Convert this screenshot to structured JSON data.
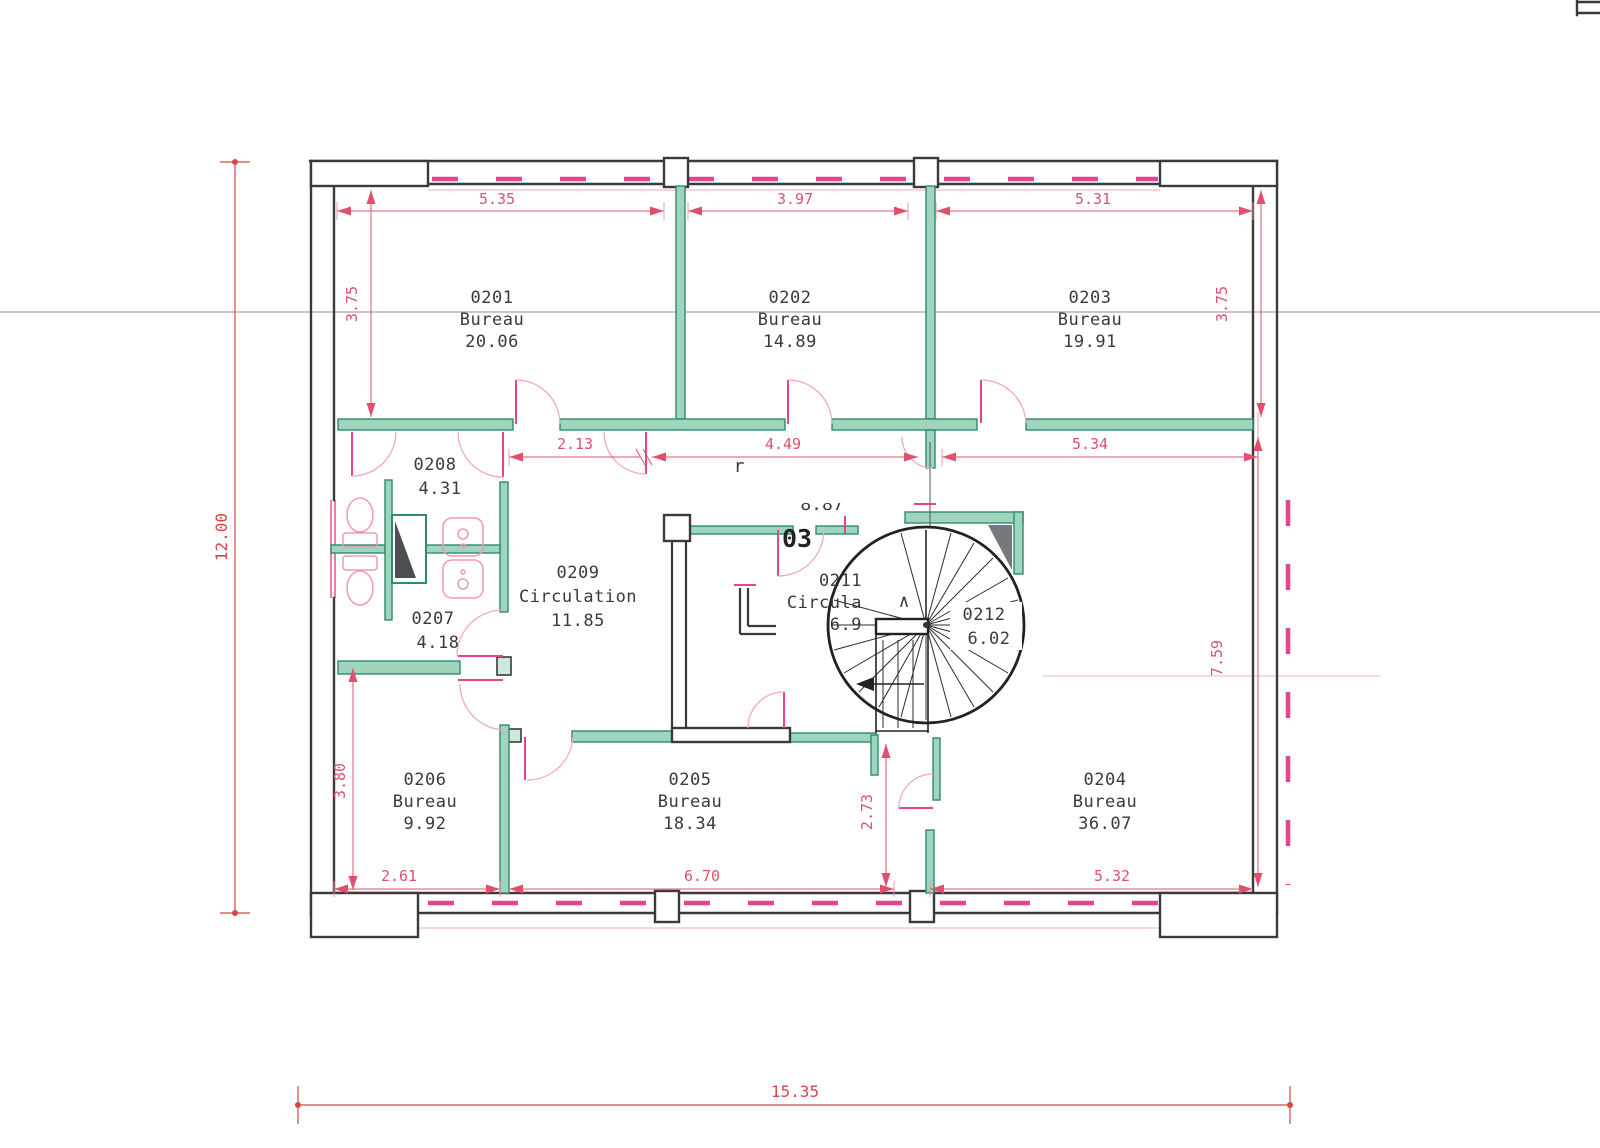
{
  "rooms": [
    {
      "id": "0201",
      "type": "Bureau",
      "area": "20.06"
    },
    {
      "id": "0202",
      "type": "Bureau",
      "area": "14.89"
    },
    {
      "id": "0203",
      "type": "Bureau",
      "area": "19.91"
    },
    {
      "id": "0204",
      "type": "Bureau",
      "area": "36.07"
    },
    {
      "id": "0205",
      "type": "Bureau",
      "area": "18.34"
    },
    {
      "id": "0206",
      "type": "Bureau",
      "area": "9.92"
    },
    {
      "id": "0207",
      "area": "4.18"
    },
    {
      "id": "0208",
      "area": "4.31"
    },
    {
      "id": "0209",
      "type": "Circulation",
      "area": "11.85"
    },
    {
      "id": "0211",
      "type": "Circula",
      "area": "6.9"
    },
    {
      "id": "0212",
      "area": "6.02"
    }
  ],
  "dims": {
    "top": [
      "5.35",
      "3.97",
      "5.31"
    ],
    "upper_left": "3.75",
    "upper_right": "3.75",
    "mid": [
      "2.13",
      "4.49",
      "5.34"
    ],
    "overall_height": "12.00",
    "lower_left": "3.80",
    "bottom": [
      "2.61",
      "6.70",
      "5.32"
    ],
    "stair_bay": "2.73",
    "lower_right": "7.59",
    "overall_width": "15.35"
  },
  "annotations": {
    "door_number": "03",
    "fragment_letter": "r",
    "fragment_area": "8.87",
    "stair_caret": "∧"
  },
  "colors": {
    "dimension_pink": "#e0506e",
    "overall_red": "#d94545",
    "wall_black": "#3a3a3a",
    "partition_green": "#9fd4bd",
    "partition_edge": "#2e8b6e",
    "door_pink": "#e8418f",
    "fixture_pink": "#f096be",
    "text_dark": "#3a3a3a"
  }
}
